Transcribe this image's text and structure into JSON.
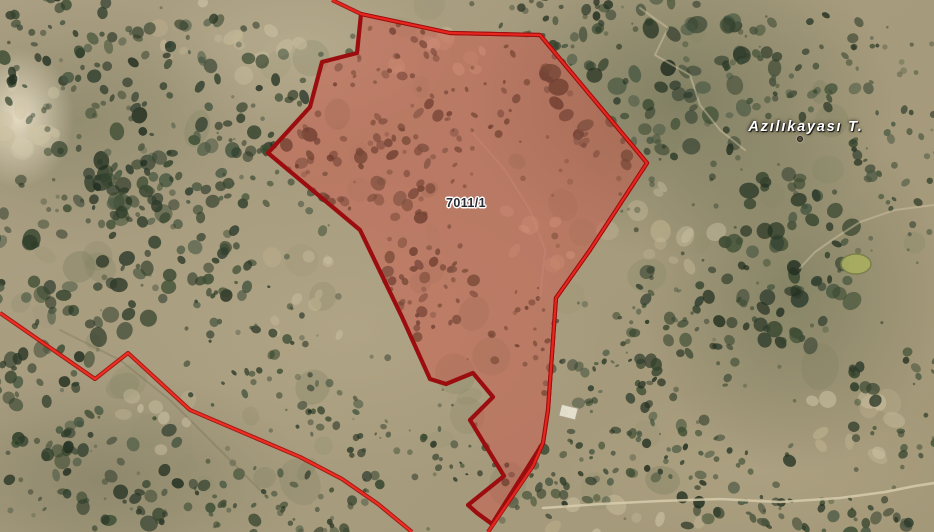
{
  "map": {
    "view_kind": "satellite-cadastral-parcel-query",
    "parcel": {
      "label": "7011/1",
      "label_pos": {
        "x": 466,
        "y": 203
      },
      "fill_color": "rgba(210,75,65,0.42)",
      "stroke_color": "#9c0d10",
      "shared_boundary_color": "#e7261d",
      "polygon": [
        [
          361,
          14
        ],
        [
          450,
          33
        ],
        [
          540,
          35
        ],
        [
          647,
          163
        ],
        [
          590,
          250
        ],
        [
          556,
          298
        ],
        [
          548,
          410
        ],
        [
          543,
          443
        ],
        [
          492,
          524
        ],
        [
          477,
          513
        ],
        [
          468,
          505
        ],
        [
          504,
          476
        ],
        [
          470,
          420
        ],
        [
          493,
          397
        ],
        [
          473,
          373
        ],
        [
          446,
          384
        ],
        [
          430,
          379
        ],
        [
          402,
          317
        ],
        [
          360,
          230
        ],
        [
          268,
          153
        ],
        [
          310,
          107
        ],
        [
          322,
          62
        ],
        [
          357,
          53
        ]
      ]
    },
    "boundary_lines": [
      {
        "name": "shared-parcel-boundary-line",
        "color": "#e7261d",
        "points": [
          [
            332,
            0
          ],
          [
            361,
            14
          ],
          [
            450,
            33
          ],
          [
            540,
            35
          ],
          [
            647,
            163
          ],
          [
            590,
            250
          ],
          [
            556,
            298
          ],
          [
            548,
            410
          ],
          [
            543,
            443
          ],
          [
            533,
            466
          ],
          [
            488,
            532
          ]
        ]
      },
      {
        "name": "adjacent-parcel-boundary-line",
        "color": "#ee2f20",
        "points": [
          [
            0,
            313
          ],
          [
            95,
            379
          ],
          [
            128,
            353
          ],
          [
            190,
            410
          ],
          [
            300,
            457
          ],
          [
            342,
            479
          ],
          [
            378,
            504
          ],
          [
            412,
            532
          ]
        ]
      }
    ],
    "place_label": {
      "text": "Azılıkayası T.",
      "x": 806,
      "y": 127
    },
    "peak_marker": {
      "x": 800,
      "y": 139
    }
  }
}
